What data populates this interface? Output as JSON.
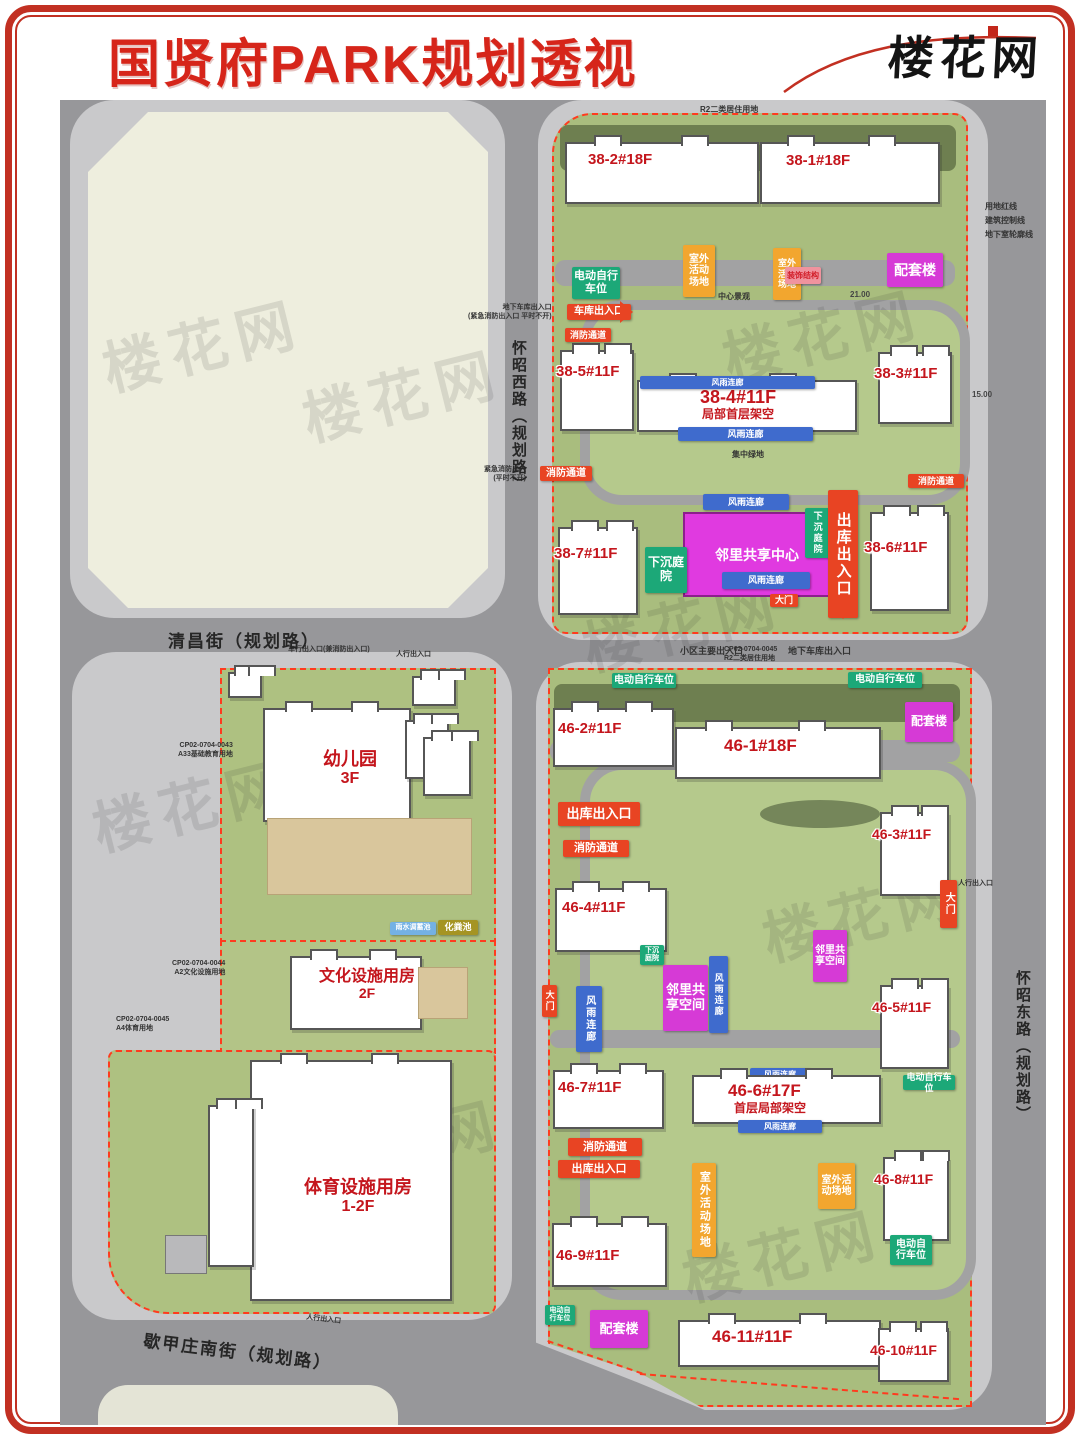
{
  "header": {
    "title": "国贤府PARK规划透视",
    "logo": "楼花网"
  },
  "streets": {
    "qingchang": "清昌街（规划路）",
    "huaizhao_west": "怀昭西路（规划路）",
    "huaizhao_east": "怀昭东路（规划路）",
    "xiejiazhuang_south": "歇甲庄南街（规划路）"
  },
  "buildings": {
    "b38_1": "38-1#18F",
    "b38_2": "38-2#18F",
    "b38_3": "38-3#11F",
    "b38_4": "38-4#11F",
    "b38_4_note": "局部首层架空",
    "b38_5": "38-5#11F",
    "b38_6": "38-6#11F",
    "b38_7": "38-7#11F",
    "b46_1": "46-1#18F",
    "b46_2": "46-2#11F",
    "b46_3": "46-3#11F",
    "b46_4": "46-4#11F",
    "b46_5": "46-5#11F",
    "b46_6": "46-6#17F",
    "b46_6_note": "首层局部架空",
    "b46_7": "46-7#11F",
    "b46_8": "46-8#11F",
    "b46_9": "46-9#11F",
    "b46_10": "46-10#11F",
    "b46_11": "46-11#11F"
  },
  "facilities": {
    "kindergarten": "幼儿园",
    "kindergarten_floors": "3F",
    "cultural": "文化设施用房",
    "cultural_floors": "2F",
    "sports": "体育设施用房",
    "sports_floors": "1-2F"
  },
  "tags": {
    "ebike": "电动自行车位",
    "garage": "车库出入口",
    "fire": "消防通道",
    "exit": "出库出入口",
    "gate": "大门",
    "sunken": "下沉庭院",
    "outdoor": "室外活动场地",
    "decor": "装饰结构",
    "support": "配套楼",
    "corridor": "风雨连廊",
    "neighbor_center": "邻里共享中心",
    "neighbor_space": "邻里共享空间",
    "septic": "化粪池",
    "rain_tank": "雨水调蓄池"
  },
  "annotations": {
    "r2_use": "R2二类居住用地",
    "central_landscape": "中心景观",
    "central_green": "集中绿地",
    "main_gate": "小区主要出入口",
    "ug_garage": "地下车库出入口",
    "ug_note": "(紧急消防出入口 平时不开)",
    "emerg1": "紧急消防出入",
    "emerg2": "(平时不开)",
    "cp43": "CP02-0704-0043",
    "a33": "A33基础教育用地",
    "cp44": "CP02-0704-0044",
    "a2": "A2文化设施用地",
    "cp45": "CP02-0704-0045",
    "a4": "A4体育用地",
    "vehicle_ent": "车行出入口(兼消防出入口)",
    "ped_ent": "人行出入口",
    "line_red": "用地红线",
    "line_ctrl": "建筑控制线",
    "line_base": "地下室轮廓线",
    "dim15": "15.00",
    "dim21": "21.00"
  },
  "watermark": "楼花网",
  "colors": {
    "accent_red": "#d6251a",
    "tag_red": "#e84423",
    "tag_green": "#1ca878",
    "tag_orange": "#f2a62f",
    "tag_magenta": "#d63ad6",
    "tag_blue": "#3f6bcd",
    "tag_pink": "#f0939e",
    "tag_olive": "#a59423",
    "tag_lightblue": "#74b1e4",
    "building_label": "#c4161d",
    "boundary_dash": "#ff3b1e",
    "parcel_green": "#a9bd7e",
    "parcel_beige": "#eeeede",
    "road_gray": "#97979a",
    "sidewalk_gray": "#c9c9cb"
  }
}
